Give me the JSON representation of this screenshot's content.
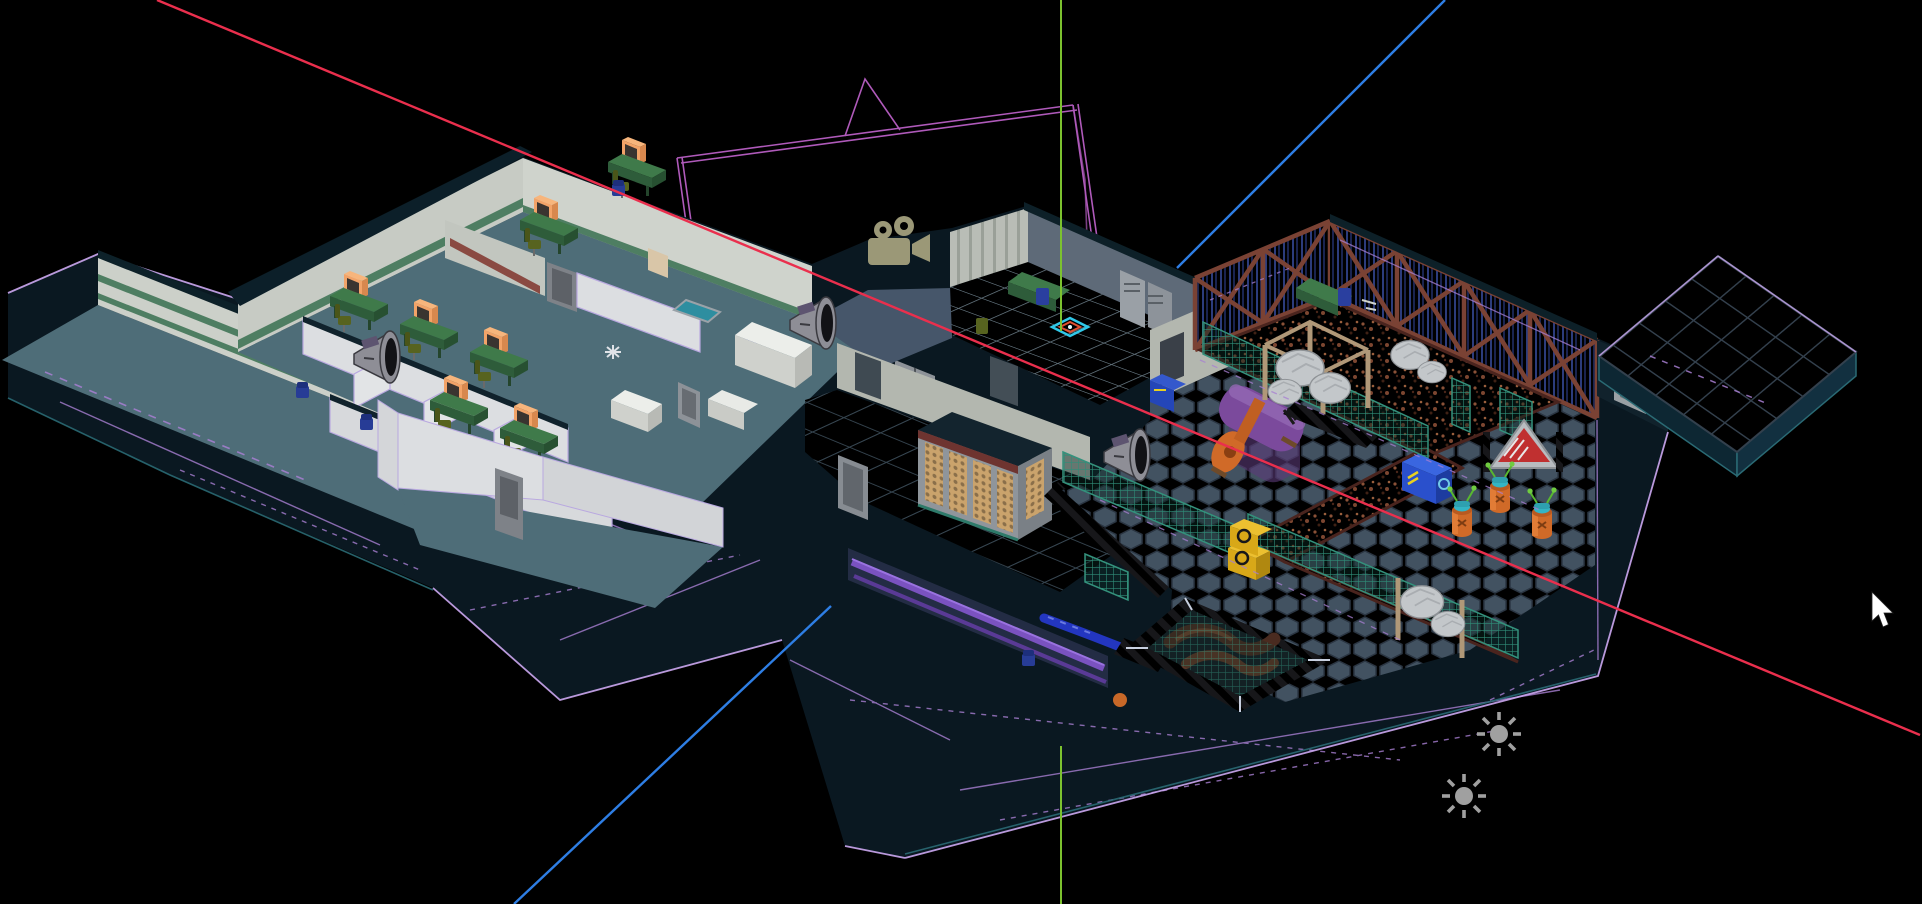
{
  "app": {
    "type": "3D level editor perspective viewport",
    "projection": "perspective",
    "background": "#000000"
  },
  "axes": {
    "x_axis": {
      "color": "#ea2f4d",
      "x1": 157,
      "y1": 0,
      "x2": 1920,
      "y2": 735
    },
    "y_axis": {
      "color": "#7cc22f",
      "seg1": {
        "x1": 1061,
        "y1": 0,
        "x2": 1061,
        "y2": 331
      },
      "seg2": {
        "x1": 1061,
        "y1": 746,
        "x2": 1061,
        "y2": 904
      }
    },
    "z_axis": {
      "color": "#2e7ee4",
      "seg1": {
        "x1": 1445,
        "y1": 0,
        "x2": 1177,
        "y2": 268
      },
      "seg2": {
        "x1": 831,
        "y1": 606,
        "x2": 514,
        "y2": 904
      }
    }
  },
  "gizmos": {
    "camera": {
      "label": "camera",
      "color": "#9b9877",
      "transform": "translate(866,218)"
    },
    "camera_frustum": {
      "color": "#b95fc4"
    },
    "lights": [
      {
        "label": "light",
        "color": "#a0a0a0",
        "transform": "translate(1499,734)"
      },
      {
        "label": "light",
        "color": "#a0a0a0",
        "transform": "translate(1464,796)"
      }
    ],
    "sound_emitters": [
      {
        "label": "speaker",
        "transform": "translate(350,328)"
      },
      {
        "label": "speaker",
        "transform": "translate(786,294)"
      },
      {
        "label": "speaker",
        "transform": "translate(1100,426)"
      }
    ],
    "cursor": {
      "color": "#ffffff",
      "transform": "translate(1872,592)"
    }
  },
  "wireframe": {
    "line_color": "#a87fd2",
    "highlight_color": "#cda9f2",
    "shell_edge": "#2a6a74"
  },
  "palette": {
    "shell_dark": "#0a1821",
    "floor_teal": "#4e6d78",
    "marble": "#ccd0c9",
    "green_stripe": "#4e7e62",
    "partition_white": "#dcdee1",
    "desk_green": "#3f7a4a",
    "monitor_orange": "#f2a368",
    "chair_olive": "#57631f",
    "hex_floor": "#3b4956",
    "big_tile": "#5c7078",
    "security_tile": "#8f9aa1",
    "blue_wall": "#232f63",
    "truss_rust": "#7a4234",
    "catwalk_rust": "#6b392b",
    "fence_teal": "#2f8d78",
    "tank_purple": "#7b4a9c",
    "tank_orange": "#d06a28",
    "hazard_yellow": "#ecc818",
    "boulder_gray": "#c3c7ca",
    "platform_tile": "#5b6b79",
    "crate_yellow": "#d8a818",
    "crate_blue": "#2a50cc",
    "barrel_orange": "#d06a28",
    "barrel_cap_teal": "#34b4c4"
  },
  "scene": {
    "areas": [
      {
        "label": "office-yard"
      },
      {
        "label": "office-cubicles"
      },
      {
        "label": "meeting-rooms"
      },
      {
        "label": "storage-annex"
      },
      {
        "label": "corridor"
      },
      {
        "label": "security-room"
      },
      {
        "label": "warehouse-hall"
      },
      {
        "label": "tile-platform"
      }
    ],
    "props": [
      "cubicle-workstation",
      "crt-monitor",
      "office-chair",
      "storage-bin",
      "marble-counter",
      "floor-rug",
      "metal-door",
      "bottle-rack-cabinet",
      "hazard-ramp",
      "floor-pipe",
      "purple-tank",
      "rock-pile",
      "wood-canopy",
      "hazard-pit",
      "alien-barrel",
      "yellow-crate",
      "blue-crate",
      "warning-sign",
      "mesh-fence",
      "catwalk",
      "truss-wall",
      "locker-cabinet",
      "security-desk",
      "entity-marker"
    ]
  }
}
